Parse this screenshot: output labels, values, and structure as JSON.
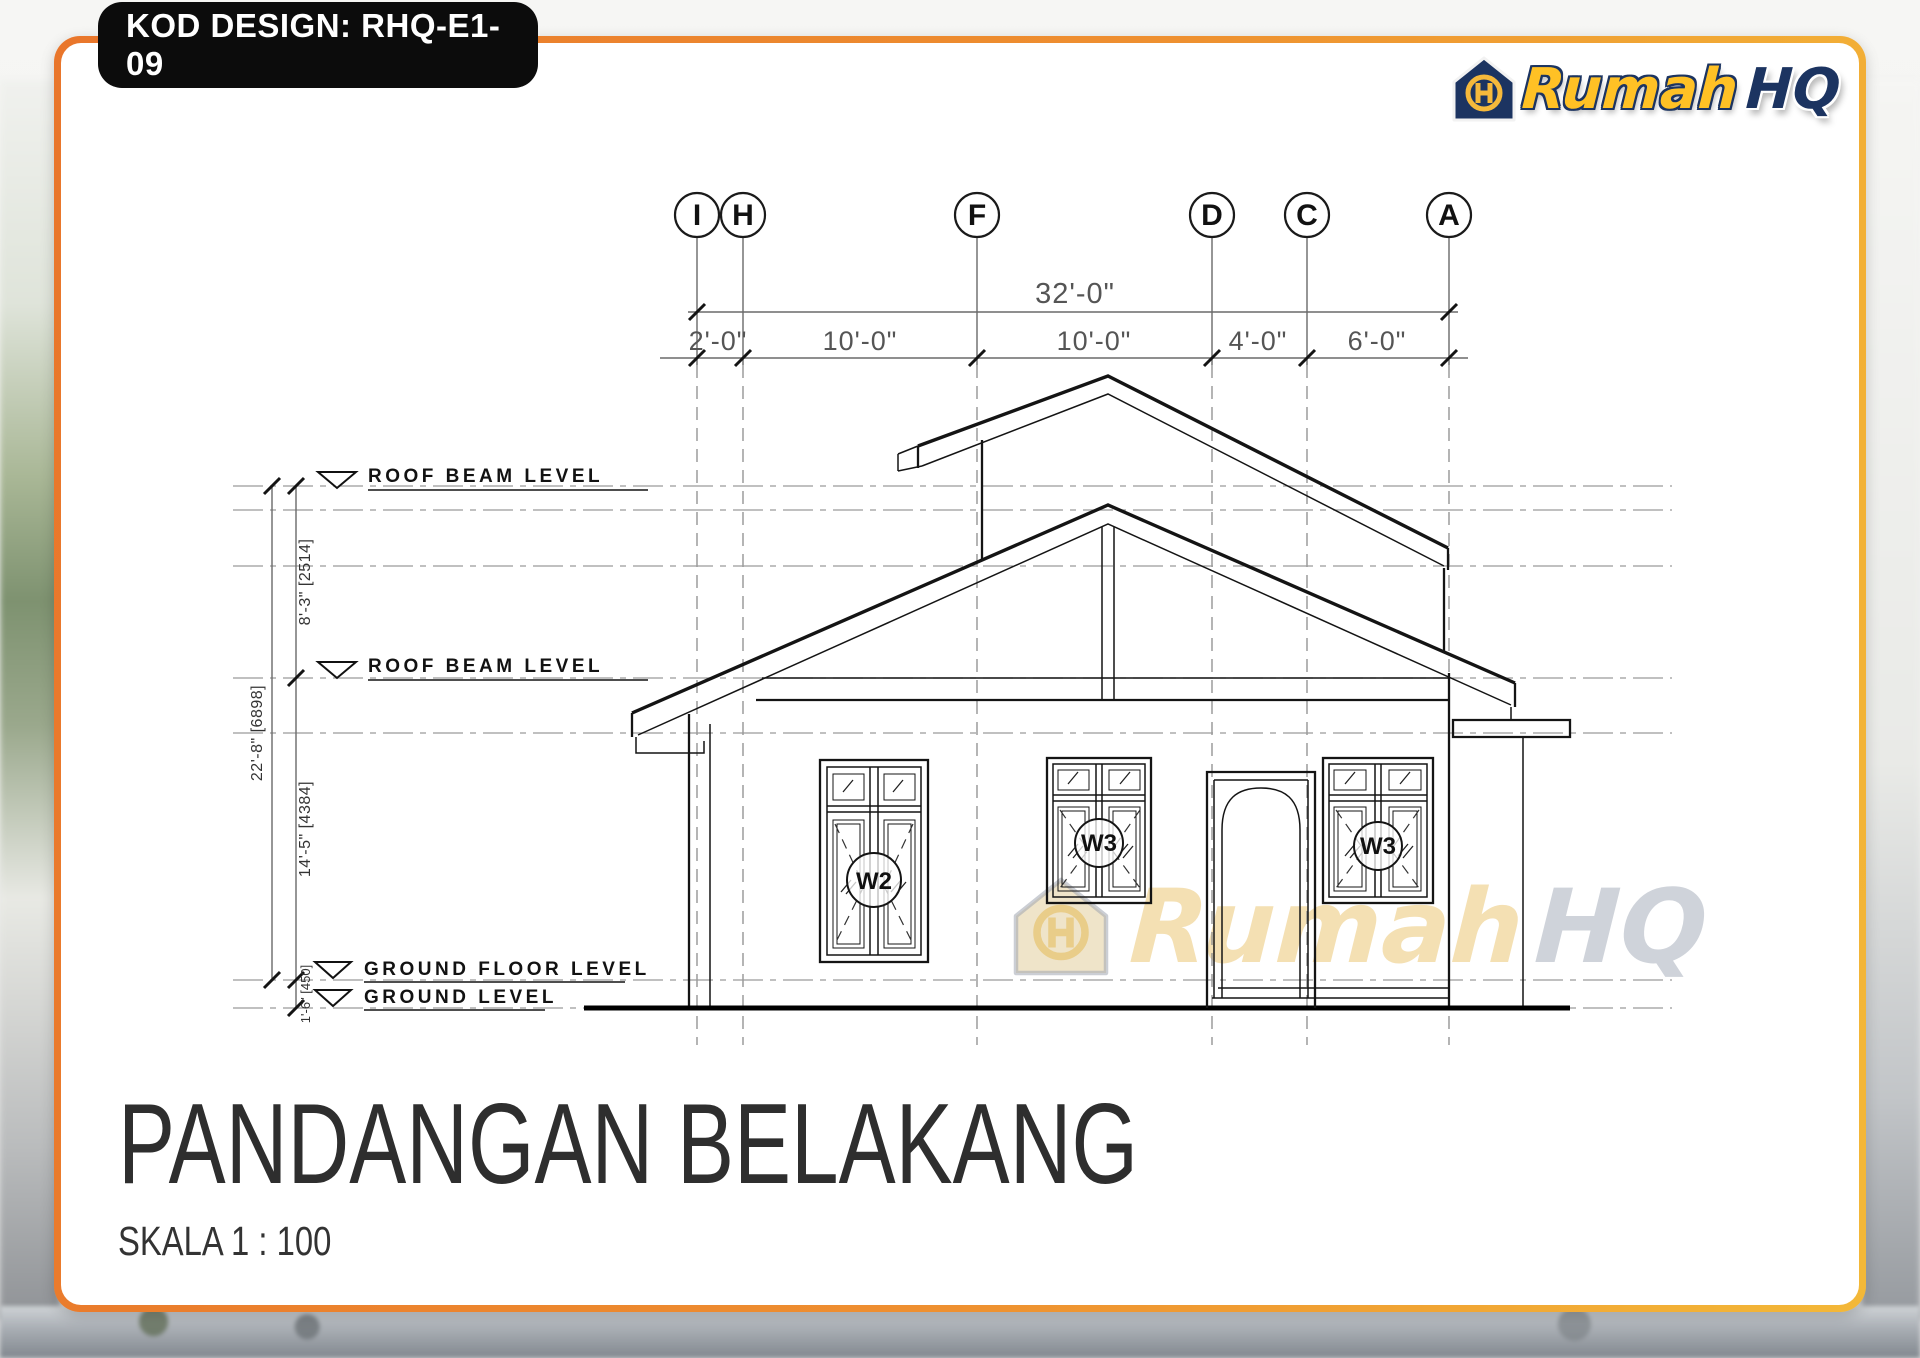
{
  "badge": {
    "text": "KOD DESIGN: RHQ-E1-09"
  },
  "logo": {
    "word1": "Rumah",
    "word2": "HQ",
    "gold": "#ffc125",
    "navy": "#1c3461"
  },
  "watermark": {
    "word1": "Rumah",
    "word2": "HQ"
  },
  "drawing": {
    "grid_bubbles": [
      "I",
      "H",
      "F",
      "D",
      "C",
      "A"
    ],
    "dim_overall": "32'-0\"",
    "dim_segments": [
      "2'-0\"",
      "10'-0\"",
      "10'-0\"",
      "4'-0\"",
      "6'-0\""
    ],
    "vertical_dims": [
      "8'-3\" [2514]",
      "22'-8\" [6898]",
      "14'-5\" [4384]",
      "1'-6\" [450]"
    ],
    "levels": [
      "ROOF BEAM LEVEL",
      "ROOF BEAM LEVEL",
      "GROUND FLOOR LEVEL",
      "GROUND LEVEL"
    ],
    "window_labels": [
      "W2",
      "W3",
      "W3"
    ]
  },
  "title": {
    "heading": "PANDANGAN BELAKANG",
    "scale": "SKALA 1 : 100"
  },
  "frame_colors": {
    "orange": "#e9762b",
    "gold": "#f3b838"
  }
}
